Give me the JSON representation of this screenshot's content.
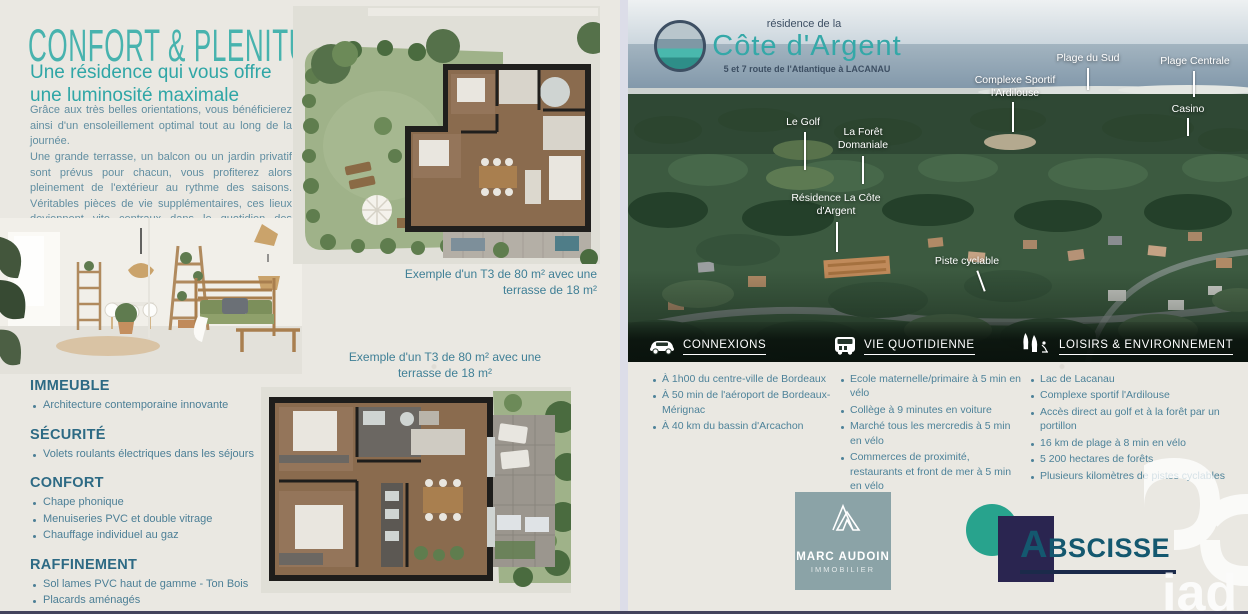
{
  "colors": {
    "accent_teal": "#3fb0ab",
    "heading_blue": "#2d6a84",
    "body_text": "#618ea1",
    "bullet_text": "#4d8299",
    "band_overlay": "#0a140d",
    "marc_audoin_bg": "#8ba3a7",
    "abscisse_teal": "#28a38d",
    "abscisse_navy": "#2a2550",
    "abscisse_text": "#14586f"
  },
  "left_panel": {
    "title": "CONFORT & PLENITUDE",
    "subtitle": "Une résidence qui vous offre une luminosité maximale",
    "paragraph1": "Grâce aux très belles orientations, vous bénéficierez ainsi d'un ensoleillement optimal tout au long de la journée.",
    "paragraph2": "Une grande terrasse, un balcon ou un jardin privatif sont prévus pour chacun, vous profiterez alors pleinement de l'extérieur au rythme des saisons. Véritables pièces de vie supplémentaires, ces lieux deviennent vite centraux dans le quotidien des occupants.",
    "floorplan1_caption": "Exemple d'un T3 de 80 m² avec une terrasse de 18 m²",
    "floorplan2_caption": "Exemple d'un T3 de 80 m² avec une terrasse de 18 m²",
    "sections": [
      {
        "heading": "IMMEUBLE",
        "items": [
          "Architecture contemporaine innovante"
        ]
      },
      {
        "heading": "SÉCURITÉ",
        "items": [
          "Volets roulants électriques dans les séjours"
        ]
      },
      {
        "heading": "CONFORT",
        "items": [
          "Chape phonique",
          "Menuiseries PVC et double vitrage",
          "Chauffage individuel au gaz"
        ]
      },
      {
        "heading": "RAFFINEMENT",
        "items": [
          "Sol lames PVC haut de gamme - Ton Bois",
          "Placards aménagés",
          "Chauffage par climatisation pour les duplex"
        ]
      }
    ]
  },
  "right_panel": {
    "brand": {
      "top_line": "résidence de la",
      "name": "Côte d'Argent",
      "address": "5 et 7 route de l'Atlantique à LACANAU",
      "logo_icon": "wave-circle-icon"
    },
    "photo_labels": {
      "le_golf": "Le Golf",
      "la_foret": "La Forêt Domaniale",
      "residence": "Résidence La Côte d'Argent",
      "piste_cyclable": "Piste cyclable",
      "complexe_sportif": "Complexe Sportif l'Ardilouse",
      "plage_du_sud": "Plage du Sud",
      "plage_centrale": "Plage Centrale",
      "casino": "Casino"
    },
    "columns": [
      {
        "header": "CONNEXIONS",
        "icon": "car-icon",
        "items": [
          "À 1h00 du centre-ville de Bordeaux",
          "À 50 min de l'aéroport de Bordeaux-Mérignac",
          "À 40 km du bassin d'Arcachon"
        ]
      },
      {
        "header": "VIE QUOTIDIENNE",
        "icon": "van-icon",
        "items": [
          "Ecole maternelle/primaire à 5 min en vélo",
          "Collège à 9 minutes en voiture",
          "Marché tous les mercredis à 5 min en vélo",
          "Commerces de proximité, restaurants et front de mer à 5 min en vélo"
        ]
      },
      {
        "header": "LOISIRS & ENVIRONNEMENT",
        "icon": "trees-cyclist-icon",
        "items": [
          "Lac de Lacanau",
          "Complexe sportif l'Ardilouse",
          "Accès direct au golf et à la forêt par un portillon",
          "16 km de plage à 8 min en vélo",
          "5 200 hectares de forêts",
          "Plusieurs kilomètres de pistes cyclables"
        ]
      }
    ],
    "partner_logos": {
      "marc_audoin": {
        "name": "MARC AUDOIN",
        "subtitle": "IMMOBILIER",
        "icon": "mountain-icon"
      },
      "abscisse": {
        "name": "BSCISSE",
        "initial": "A"
      },
      "iad": {
        "name": "iad",
        "icon": "iad-loop-icon"
      }
    }
  }
}
